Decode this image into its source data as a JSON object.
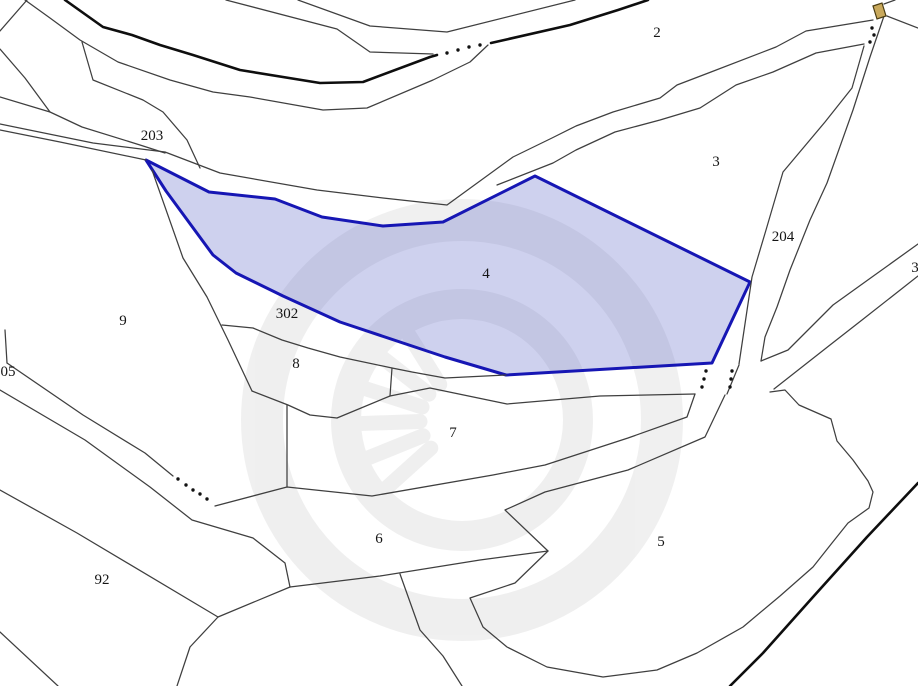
{
  "canvas": {
    "width": 918,
    "height": 686,
    "background": "#ffffff"
  },
  "colors": {
    "thin_boundary": "#3f3f3f",
    "thick_boundary": "#0e0e0e",
    "highlight_stroke": "#1616b4",
    "highlight_fill": "rgba(92,104,200,0.30)",
    "label_color": "#151515",
    "dot_color": "#111111",
    "symbol_fill": "#c9a95c",
    "symbol_stroke": "#4a3c12",
    "watermark_color": "#000000",
    "watermark_opacity": 0.06
  },
  "labels": [
    {
      "name": "parcel-label-2",
      "text": "2",
      "x": 657,
      "y": 33
    },
    {
      "name": "parcel-label-3",
      "text": "3",
      "x": 716,
      "y": 162
    },
    {
      "name": "parcel-label-3-right-edge",
      "text": "3",
      "x": 915,
      "y": 268
    },
    {
      "name": "parcel-label-4",
      "text": "4",
      "x": 486,
      "y": 274
    },
    {
      "name": "parcel-label-5",
      "text": "5",
      "x": 661,
      "y": 542
    },
    {
      "name": "parcel-label-6",
      "text": "6",
      "x": 379,
      "y": 539
    },
    {
      "name": "parcel-label-7",
      "text": "7",
      "x": 453,
      "y": 433
    },
    {
      "name": "parcel-label-8",
      "text": "8",
      "x": 296,
      "y": 364
    },
    {
      "name": "parcel-label-9",
      "text": "9",
      "x": 123,
      "y": 321
    },
    {
      "name": "parcel-label-92",
      "text": "92",
      "x": 102,
      "y": 580
    },
    {
      "name": "parcel-label-05-left-edge",
      "text": "05",
      "x": 8,
      "y": 372
    },
    {
      "name": "road-label-203",
      "text": "203",
      "x": 152,
      "y": 136
    },
    {
      "name": "road-label-204",
      "text": "204",
      "x": 783,
      "y": 237
    },
    {
      "name": "road-label-302",
      "text": "302",
      "x": 287,
      "y": 314
    }
  ],
  "label_font_size": 15,
  "highlighted_parcel": {
    "label": "4",
    "points": [
      [
        146,
        160
      ],
      [
        209,
        192
      ],
      [
        275,
        199
      ],
      [
        322,
        217
      ],
      [
        383,
        226
      ],
      [
        443,
        222
      ],
      [
        535,
        176
      ],
      [
        750,
        282
      ],
      [
        712,
        363
      ],
      [
        506,
        375
      ],
      [
        445,
        357
      ],
      [
        340,
        322
      ],
      [
        283,
        296
      ],
      [
        236,
        273
      ],
      [
        213,
        255
      ],
      [
        166,
        191
      ]
    ]
  },
  "thin_lines": [
    [
      [
        27,
        0
      ],
      [
        0,
        31
      ]
    ],
    [
      [
        25,
        0
      ],
      [
        50,
        18
      ],
      [
        80,
        40
      ],
      [
        118,
        62
      ],
      [
        170,
        80
      ],
      [
        213,
        92
      ],
      [
        250,
        97
      ],
      [
        323,
        110
      ],
      [
        367,
        108
      ],
      [
        433,
        80
      ],
      [
        470,
        62
      ],
      [
        488,
        45
      ]
    ],
    [
      [
        298,
        0
      ],
      [
        370,
        26
      ],
      [
        447,
        32
      ],
      [
        575,
        0
      ]
    ],
    [
      [
        226,
        0
      ],
      [
        337,
        29
      ],
      [
        370,
        52
      ],
      [
        433,
        54
      ]
    ],
    [
      [
        0,
        124
      ],
      [
        93,
        143
      ],
      [
        165,
        152
      ],
      [
        220,
        173
      ],
      [
        317,
        190
      ],
      [
        383,
        198
      ],
      [
        447,
        205
      ],
      [
        513,
        157
      ],
      [
        552,
        138
      ],
      [
        576,
        126
      ],
      [
        613,
        112
      ],
      [
        660,
        98
      ],
      [
        677,
        85
      ],
      [
        711,
        72
      ],
      [
        776,
        47
      ],
      [
        806,
        31
      ],
      [
        873,
        20
      ]
    ],
    [
      [
        0,
        130
      ],
      [
        60,
        142
      ],
      [
        146,
        160
      ]
    ],
    [
      [
        497,
        185
      ],
      [
        553,
        163
      ],
      [
        576,
        150
      ],
      [
        615,
        132
      ],
      [
        660,
        120
      ],
      [
        700,
        108
      ],
      [
        736,
        85
      ],
      [
        773,
        72
      ],
      [
        816,
        53
      ],
      [
        864,
        44
      ]
    ],
    [
      [
        864,
        46
      ],
      [
        852,
        88
      ],
      [
        825,
        122
      ],
      [
        783,
        172
      ],
      [
        766,
        230
      ],
      [
        752,
        277
      ],
      [
        739,
        364
      ]
    ],
    [
      [
        884,
        16
      ],
      [
        870,
        57
      ],
      [
        853,
        110
      ],
      [
        827,
        183
      ],
      [
        810,
        220
      ],
      [
        790,
        270
      ],
      [
        777,
        307
      ],
      [
        765,
        337
      ],
      [
        761,
        361
      ]
    ],
    [
      [
        884,
        4
      ],
      [
        895,
        0
      ]
    ],
    [
      [
        887,
        16
      ],
      [
        918,
        28
      ]
    ],
    [
      [
        761,
        361
      ],
      [
        788,
        350
      ],
      [
        833,
        305
      ],
      [
        872,
        277
      ],
      [
        918,
        244
      ]
    ],
    [
      [
        774,
        389
      ],
      [
        830,
        345
      ],
      [
        862,
        320
      ],
      [
        918,
        276
      ]
    ],
    [
      [
        252,
        391
      ],
      [
        288,
        405
      ],
      [
        310,
        415
      ],
      [
        337,
        418
      ],
      [
        390,
        396
      ],
      [
        430,
        388
      ],
      [
        507,
        404
      ],
      [
        600,
        396
      ],
      [
        695,
        394
      ]
    ],
    [
      [
        152,
        170
      ],
      [
        183,
        258
      ],
      [
        207,
        297
      ],
      [
        228,
        340
      ],
      [
        252,
        391
      ]
    ],
    [
      [
        222,
        325
      ],
      [
        253,
        328
      ],
      [
        282,
        340
      ],
      [
        308,
        348
      ],
      [
        340,
        357
      ],
      [
        392,
        368
      ],
      [
        412,
        372
      ],
      [
        445,
        378
      ],
      [
        506,
        375
      ]
    ],
    [
      [
        392,
        368
      ],
      [
        390,
        396
      ]
    ],
    [
      [
        287,
        405
      ],
      [
        287,
        487
      ]
    ],
    [
      [
        0,
        49
      ],
      [
        25,
        78
      ],
      [
        50,
        112
      ],
      [
        82,
        127
      ],
      [
        140,
        145
      ],
      [
        165,
        153
      ]
    ],
    [
      [
        0,
        97
      ],
      [
        50,
        112
      ]
    ],
    [
      [
        82,
        42
      ],
      [
        93,
        80
      ],
      [
        143,
        100
      ],
      [
        163,
        112
      ],
      [
        187,
        140
      ],
      [
        200,
        168
      ]
    ],
    [
      [
        5,
        330
      ],
      [
        7,
        363
      ]
    ],
    [
      [
        7,
        363
      ],
      [
        83,
        415
      ],
      [
        145,
        453
      ],
      [
        173,
        476
      ]
    ],
    [
      [
        215,
        506
      ],
      [
        287,
        487
      ],
      [
        372,
        496
      ],
      [
        493,
        475
      ],
      [
        545,
        465
      ],
      [
        628,
        438
      ],
      [
        687,
        417
      ],
      [
        695,
        394
      ]
    ],
    [
      [
        0,
        390
      ],
      [
        85,
        440
      ],
      [
        150,
        487
      ],
      [
        192,
        520
      ],
      [
        253,
        538
      ],
      [
        285,
        563
      ],
      [
        290,
        587
      ]
    ],
    [
      [
        290,
        587
      ],
      [
        380,
        576
      ],
      [
        480,
        560
      ],
      [
        548,
        551
      ]
    ],
    [
      [
        725,
        395
      ],
      [
        705,
        437
      ],
      [
        628,
        470
      ],
      [
        545,
        492
      ],
      [
        505,
        510
      ],
      [
        548,
        551
      ]
    ],
    [
      [
        548,
        551
      ],
      [
        515,
        583
      ],
      [
        470,
        598
      ],
      [
        483,
        627
      ],
      [
        507,
        647
      ],
      [
        547,
        667
      ],
      [
        603,
        677
      ],
      [
        657,
        670
      ],
      [
        697,
        653
      ],
      [
        743,
        627
      ],
      [
        780,
        596
      ],
      [
        813,
        567
      ],
      [
        832,
        543
      ],
      [
        848,
        523
      ],
      [
        869,
        508
      ],
      [
        873,
        492
      ],
      [
        868,
        481
      ],
      [
        853,
        460
      ],
      [
        837,
        441
      ],
      [
        831,
        419
      ],
      [
        799,
        405
      ],
      [
        785,
        390
      ],
      [
        770,
        392
      ]
    ],
    [
      [
        0,
        490
      ],
      [
        77,
        533
      ],
      [
        218,
        617
      ]
    ],
    [
      [
        290,
        587
      ],
      [
        218,
        617
      ],
      [
        190,
        647
      ],
      [
        177,
        686
      ]
    ],
    [
      [
        0,
        632
      ],
      [
        58,
        686
      ]
    ],
    [
      [
        400,
        574
      ],
      [
        420,
        630
      ],
      [
        443,
        656
      ],
      [
        462,
        686
      ]
    ],
    [
      [
        727,
        394
      ],
      [
        739,
        365
      ]
    ]
  ],
  "thick_lines": [
    [
      [
        65,
        0
      ],
      [
        103,
        27
      ],
      [
        132,
        35
      ],
      [
        160,
        45
      ],
      [
        193,
        55
      ],
      [
        240,
        70
      ],
      [
        320,
        83
      ],
      [
        363,
        82
      ],
      [
        430,
        57
      ],
      [
        437,
        55
      ]
    ],
    [
      [
        491,
        43
      ],
      [
        570,
        25
      ],
      [
        618,
        10
      ],
      [
        648,
        0
      ]
    ],
    [
      [
        918,
        483
      ],
      [
        867,
        537
      ],
      [
        813,
        597
      ],
      [
        763,
        653
      ],
      [
        730,
        686
      ]
    ]
  ],
  "dotted_marks": [
    [
      [
        447,
        53
      ],
      [
        458,
        50
      ],
      [
        469,
        47
      ],
      [
        480,
        45
      ]
    ],
    [
      [
        872,
        28
      ],
      [
        874,
        35
      ],
      [
        870,
        42
      ]
    ],
    [
      [
        178,
        479
      ],
      [
        186,
        485
      ],
      [
        193,
        490
      ],
      [
        200,
        494
      ],
      [
        207,
        499
      ]
    ],
    [
      [
        706,
        371
      ],
      [
        704,
        379
      ],
      [
        702,
        387
      ]
    ],
    [
      [
        732,
        371
      ],
      [
        731,
        379
      ],
      [
        730,
        387
      ]
    ]
  ],
  "dot_radius": 1.7,
  "symbol": {
    "name": "building-symbol",
    "points": [
      [
        873,
        6
      ],
      [
        882,
        3
      ],
      [
        886,
        16
      ],
      [
        877,
        19
      ]
    ]
  },
  "watermark": {
    "cx": 462,
    "cy": 420,
    "outer_radius": 200,
    "outer_width": 42,
    "inner_radius": 116,
    "inner_width": 30,
    "spoke_angles_deg": [
      138,
      158,
      178,
      198,
      218,
      238
    ],
    "spoke_inner": 42,
    "spoke_outer": 102,
    "spoke_width": 15
  }
}
